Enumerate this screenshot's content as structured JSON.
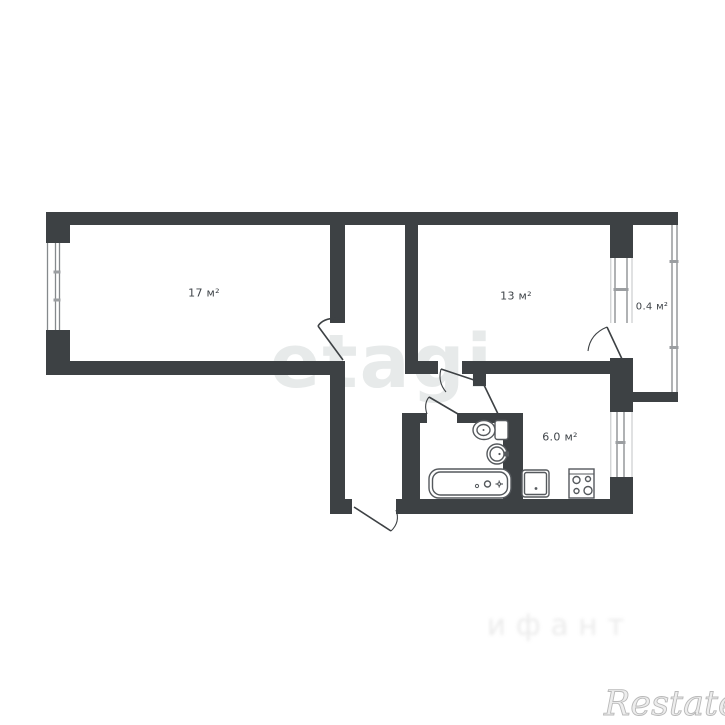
{
  "floor_plan": {
    "rooms": [
      {
        "name": "room-17",
        "area_label": "17 м²"
      },
      {
        "name": "room-13",
        "area_label": "13 м²"
      },
      {
        "name": "balcony",
        "area_label": "0.4 м²"
      },
      {
        "name": "kitchen",
        "area_label": "6.0 м²"
      }
    ],
    "colors": {
      "wall": "#3d4144",
      "fixture_stroke": "#55595d",
      "window_line": "#85898c",
      "label_text": "#3f4449"
    },
    "fixtures": [
      {
        "icon": "bathtub-icon"
      },
      {
        "icon": "toilet-icon"
      },
      {
        "icon": "washbasin-icon"
      },
      {
        "icon": "kitchen-sink-icon"
      },
      {
        "icon": "stove-icon"
      }
    ],
    "doors": [
      "entrance-door",
      "room-17-door",
      "room-13-door",
      "bathroom-door",
      "kitchen-door",
      "balcony-door"
    ],
    "windows": [
      "room-17-window",
      "room-13-window",
      "kitchen-window",
      "balcony-railing"
    ]
  },
  "watermarks": {
    "center": "etagi",
    "bottom_right": "Restate",
    "bottom_center_faint": "ифант"
  }
}
